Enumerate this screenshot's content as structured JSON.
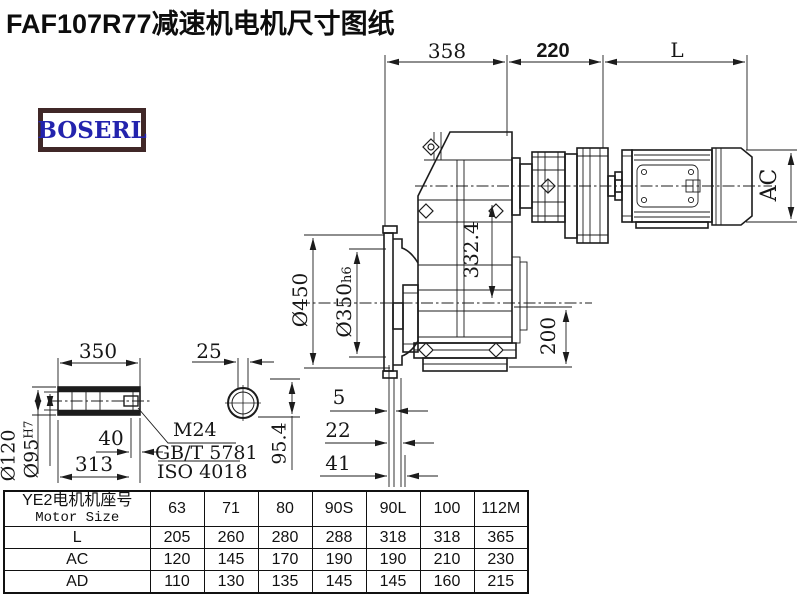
{
  "title": "FAF107R77减速机电机尺寸图纸",
  "logo": {
    "text": "BOSERL",
    "border_color": "#402828",
    "text_color": "#2323ad"
  },
  "drawing": {
    "line_color": "#1c1c1c",
    "dims_top": {
      "gearbox_length": "358",
      "adapter_length": "220",
      "motor_length": "L"
    },
    "dims_motor": {
      "motor_diameter": "AC"
    },
    "dims_gearbox": {
      "flange_diameter": "Ø450",
      "spigot_diameter": "Ø350",
      "spigot_tolerance": "h6",
      "height_332": "332.4",
      "base_height": "200"
    },
    "dims_face_offsets": {
      "offset1": "5",
      "offset2": "22",
      "offset3": "41"
    },
    "shaft_detail": {
      "length": "350",
      "plug_depth": "40",
      "bore_length": "313",
      "outer_diameter": "Ø120",
      "bore_diameter": "Ø95",
      "bore_tolerance": "H7",
      "thread": "M24",
      "standard_gb": "GB/T 5781",
      "standard_iso": "ISO 4018",
      "key_width": "25",
      "section_height": "95.4"
    }
  },
  "table": {
    "header_cn": "YE2电机机座号",
    "header_en": "Motor Size",
    "sizes": [
      "63",
      "71",
      "80",
      "90S",
      "90L",
      "100",
      "112M"
    ],
    "rows": [
      {
        "label": "L",
        "values": [
          "205",
          "260",
          "280",
          "288",
          "318",
          "318",
          "365"
        ]
      },
      {
        "label": "AC",
        "values": [
          "120",
          "145",
          "170",
          "190",
          "190",
          "210",
          "230"
        ]
      },
      {
        "label": "AD",
        "values": [
          "110",
          "130",
          "135",
          "145",
          "145",
          "160",
          "215"
        ]
      }
    ]
  }
}
